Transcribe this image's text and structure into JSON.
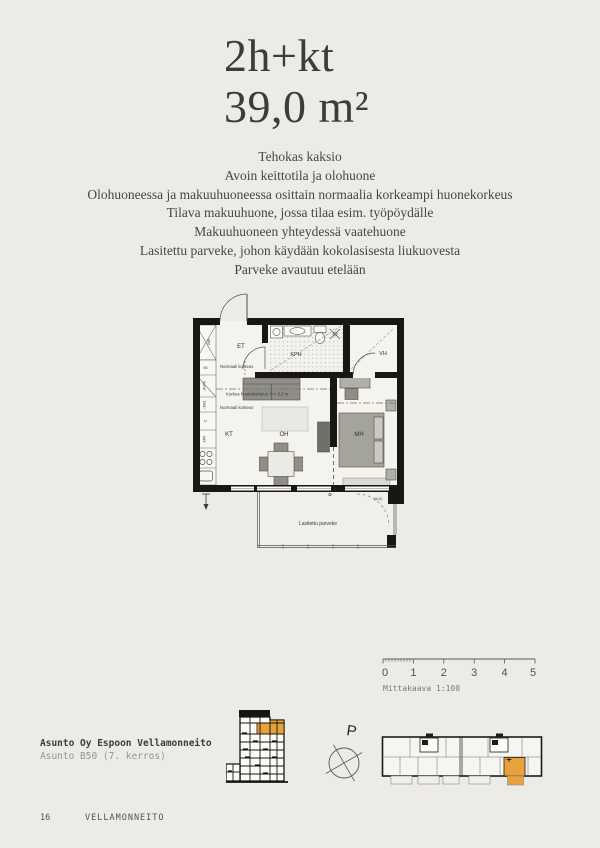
{
  "page": {
    "title": [
      "2h+kt",
      "39,0 m²"
    ],
    "description": [
      "Tehokas kaksio",
      "Avoin keittotila ja olohuone",
      "Olohuoneessa ja makuuhuoneessa osittain normaalia korkeampi huonekorkeus",
      "Tilava makuuhuone, jossa tilaa esim. työpöydälle",
      "Makuuhuoneen yhteydessä vaatehuone",
      "Lasitettu parveke, johon käydään kokolasisesta liukuovesta",
      "Parveke avautuu etelään"
    ]
  },
  "floor_plan": {
    "rooms": {
      "et": "ET",
      "kph": "KPH",
      "vh": "VH",
      "kt": "KT",
      "oh": "OH",
      "mh": "MH"
    },
    "labels": {
      "normal_height_upper": "Normaali korkeus",
      "high_ceiling": "Korkea huonekorkeus, h > 3,2 m",
      "normal_height_lower": "Normaali korkeus",
      "balcony": "Lasitettu parveke",
      "balcony_exit": "(ULK)",
      "closet": "VAR"
    },
    "appliances": {
      "sk": "SK",
      "fridge": "JK/PA",
      "micro": "(MU)",
      "oven": "U",
      "dishwasher": "APK"
    }
  },
  "scale_bar": {
    "ticks": [
      "0",
      "1",
      "2",
      "3",
      "4",
      "5"
    ],
    "caption": "Mittakaava 1:100"
  },
  "compass": {
    "north_label": "P"
  },
  "location": {
    "project": "Asunto Oy Espoon Vellamonneito",
    "apartment": "Asunto B50 (7. kerros)"
  },
  "footer": {
    "page_number": "16",
    "brand": "VELLAMONNEITO"
  },
  "colors": {
    "background": "#edebe6",
    "text_dark": "#3d3c38",
    "text_muted": "#96948d",
    "accent": "#e8a23b",
    "wall": "#181714"
  }
}
